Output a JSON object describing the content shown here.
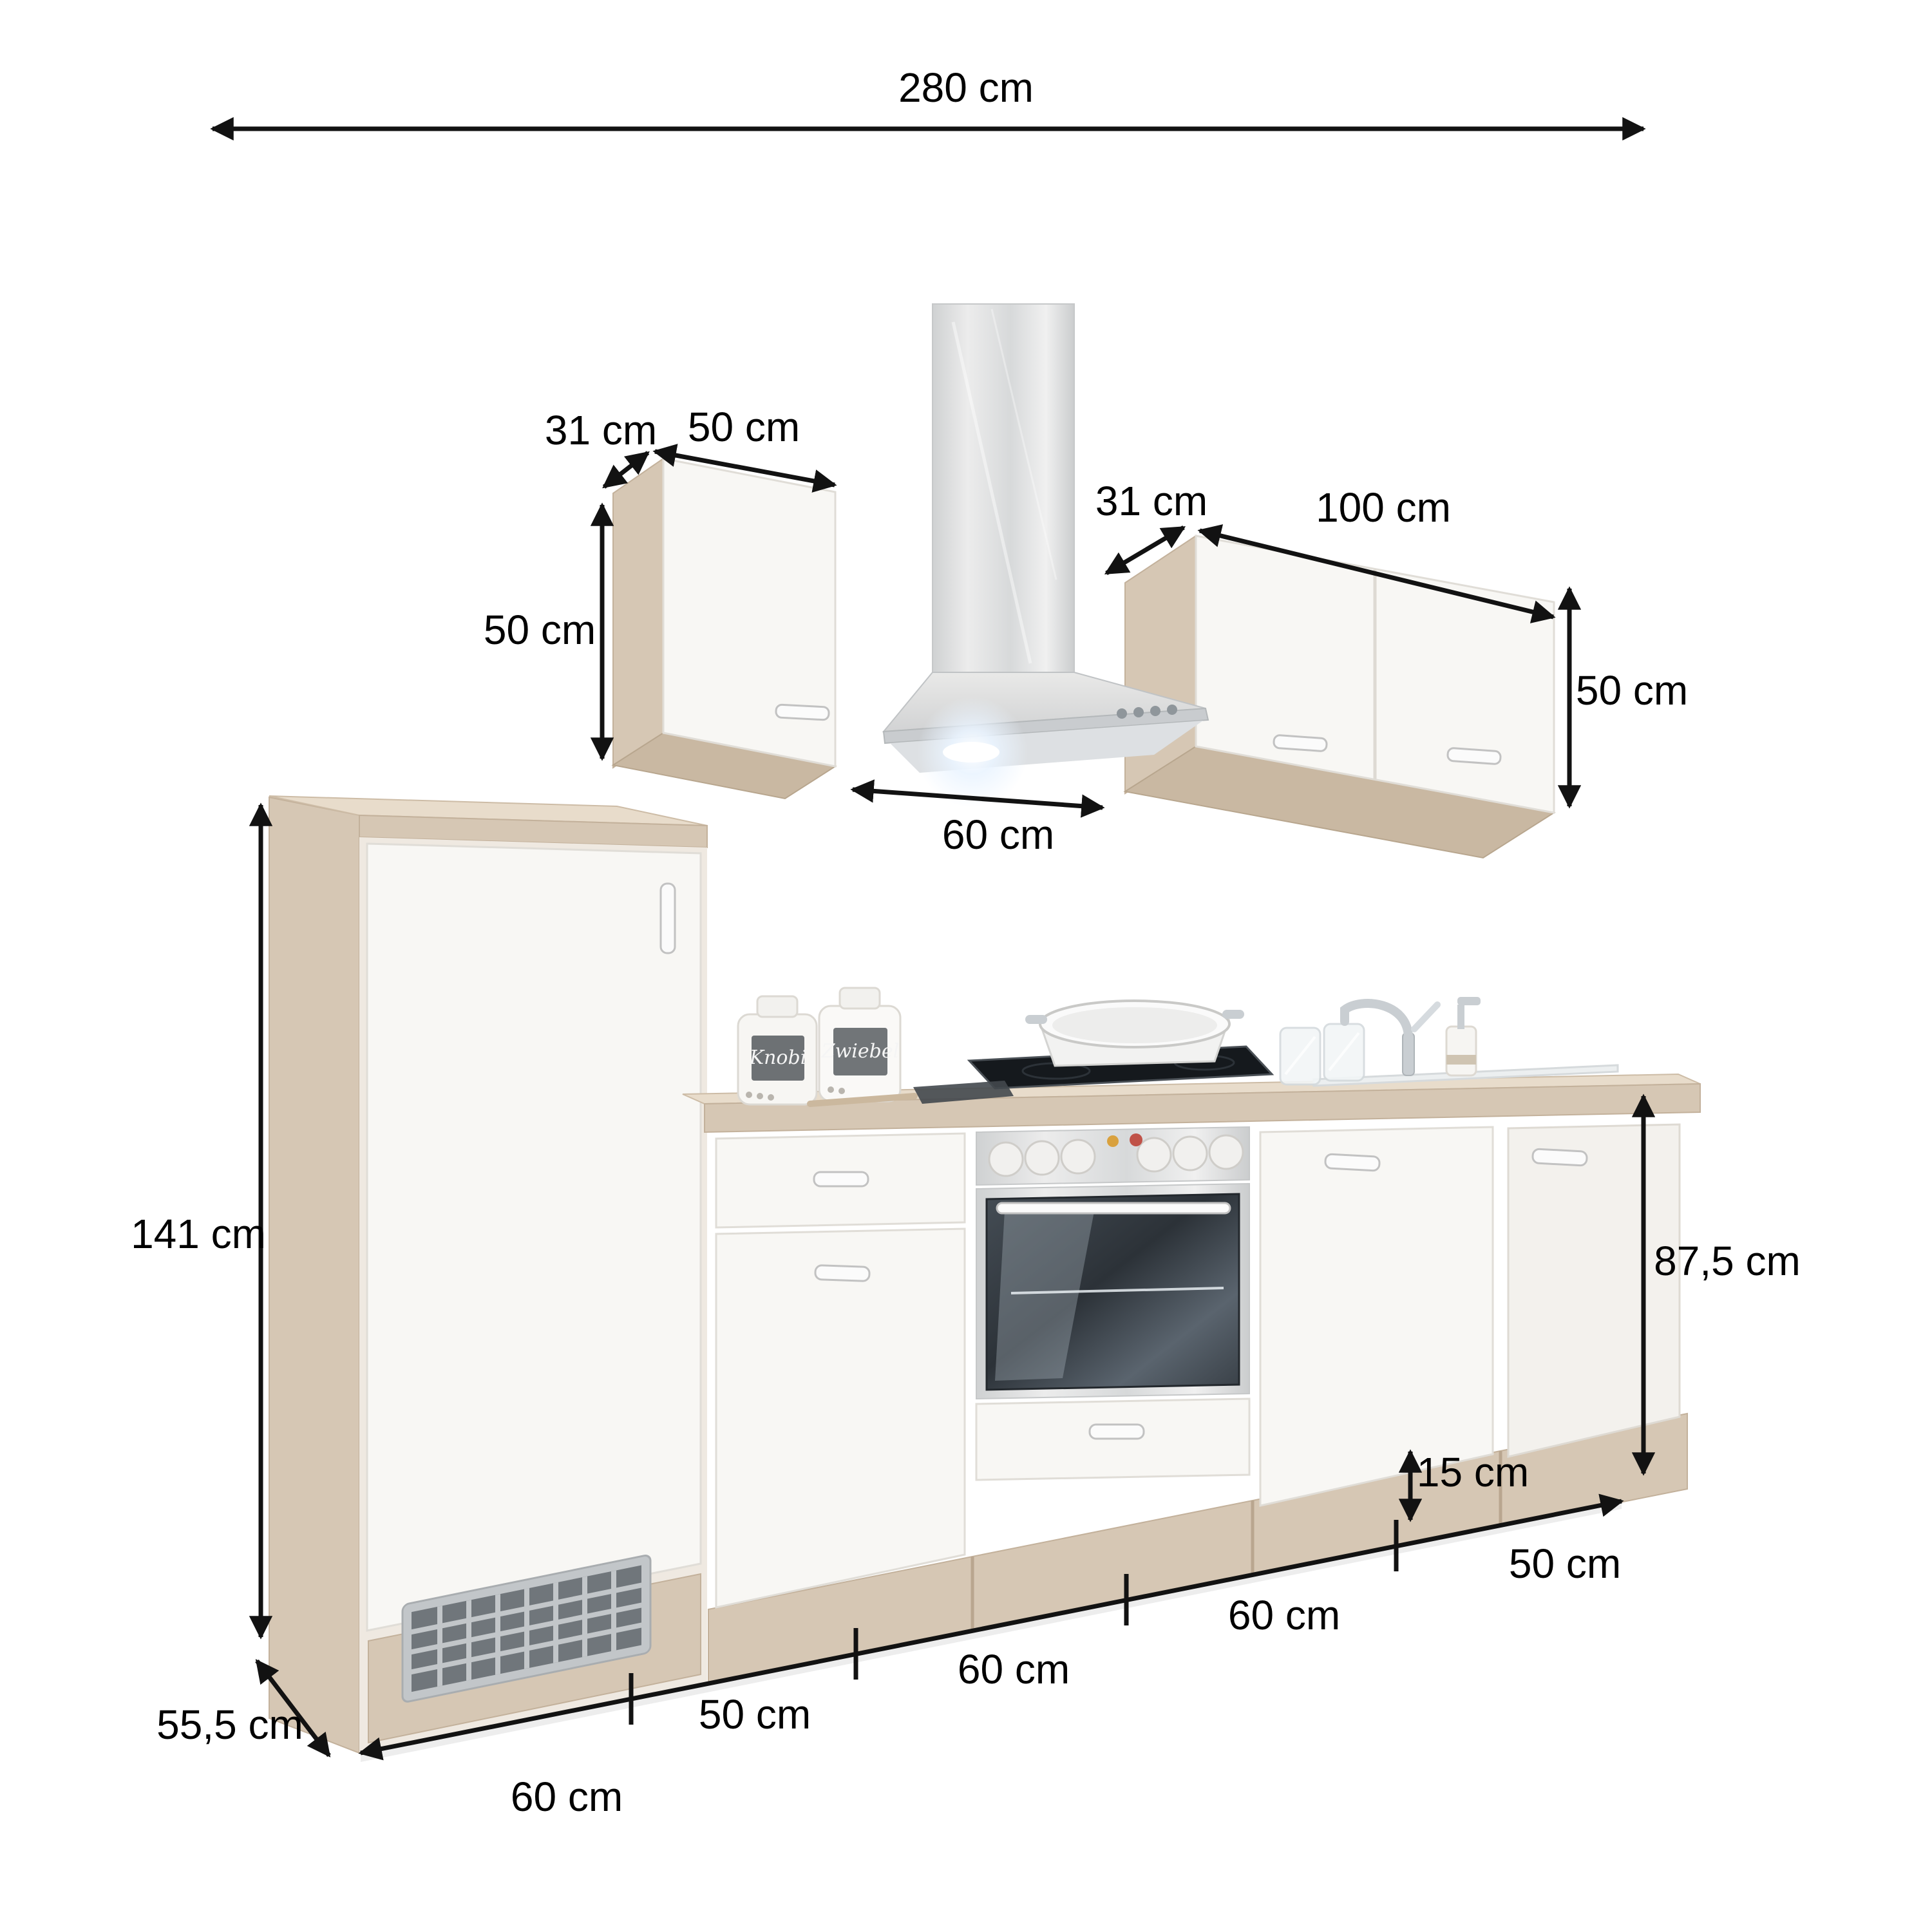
{
  "image_type": "kitchen cabinet set dimension diagram",
  "dimensions": {
    "total_width": "280 cm",
    "left_wall_cabinet": {
      "depth": "31 cm",
      "width": "50 cm",
      "height": "50 cm"
    },
    "right_wall_cabinet": {
      "depth": "31 cm",
      "width": "100 cm",
      "height": "50 cm"
    },
    "hood_width": "60 cm",
    "tall_cabinet_height": "141 cm",
    "worktop_height": "87,5 cm",
    "plinth_height": "15 cm",
    "total_depth": "55,5 cm",
    "base_segments": {
      "tall_cabinet": "60 cm",
      "drawer_unit": "50 cm",
      "oven_unit": "60 cm",
      "cabinet_60": "60 cm",
      "sink_unit": "50 cm"
    }
  },
  "decor": {
    "canister_left": "Knobi",
    "canister_right": "Zwiebel"
  },
  "colors": {
    "wood": "#d6c7b4",
    "wood_dark": "#c9b8a2",
    "front_white": "#f8f7f4",
    "stainless": "#dcdedf",
    "oven_glass": "#343b42",
    "dimension_line": "#121212"
  }
}
